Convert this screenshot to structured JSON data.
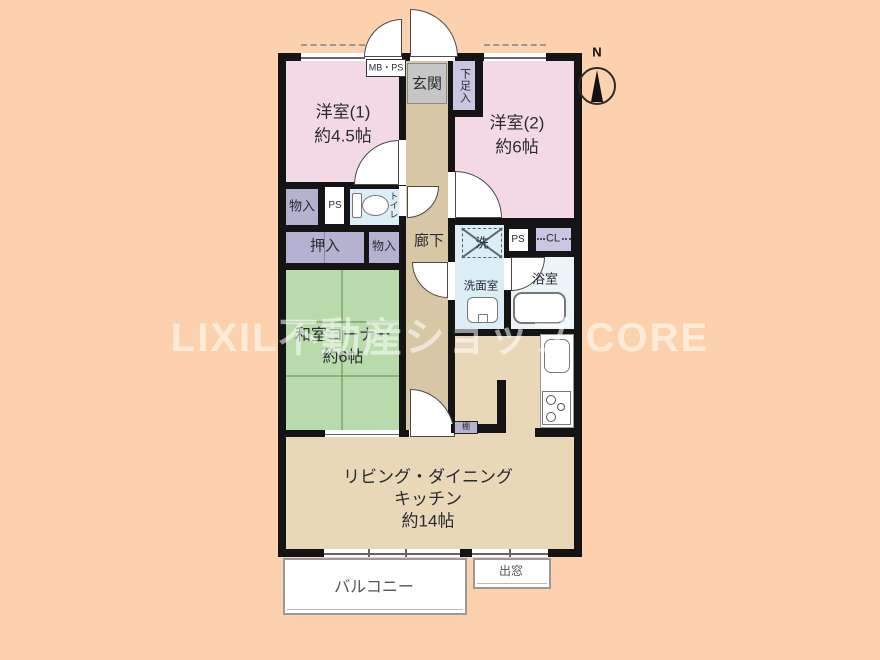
{
  "watermark": "LIXIL不動産ショップ CORE",
  "compass": {
    "north": "N"
  },
  "rooms": {
    "yoshitsu1": {
      "name": "洋室(1)",
      "size": "約4.5帖"
    },
    "yoshitsu2": {
      "name": "洋室(2)",
      "size": "約6帖"
    },
    "washitsu": {
      "name": "和室コーナー",
      "size": "約6帖"
    },
    "ldk": {
      "line1": "リビング・ダイニング",
      "line2": "キッチン",
      "size": "約14帖"
    },
    "genkan": "玄関",
    "getabako": "下足入",
    "mbps": "MB・PS",
    "rouka": "廊下",
    "monoire1": "物入",
    "ps1": "PS",
    "toilet": "トイレ",
    "oshiire": "押入",
    "monoire2": "物入",
    "sentakuki": "洗",
    "ps2": "PS",
    "cl": "CL",
    "senmenshitsu": "洗面室",
    "yokushitsu": "浴室",
    "tana": "棚",
    "balcony": "バルコニー",
    "demado": "出窓"
  },
  "colors": {
    "background": "#fbd2ad",
    "wall": "#141414",
    "western_room": "#f3d9e6",
    "tatami": "#b9daaa",
    "closet": "#b5b2d1",
    "closet_light": "#c8c6e0",
    "corridor": "#d8c7a4",
    "living": "#e9d8b8",
    "wet_area": "#dbeef6",
    "bath": "#ecf4f8",
    "genkan_gray": "#c6c6c6",
    "watermark_text": "#ffffff"
  }
}
